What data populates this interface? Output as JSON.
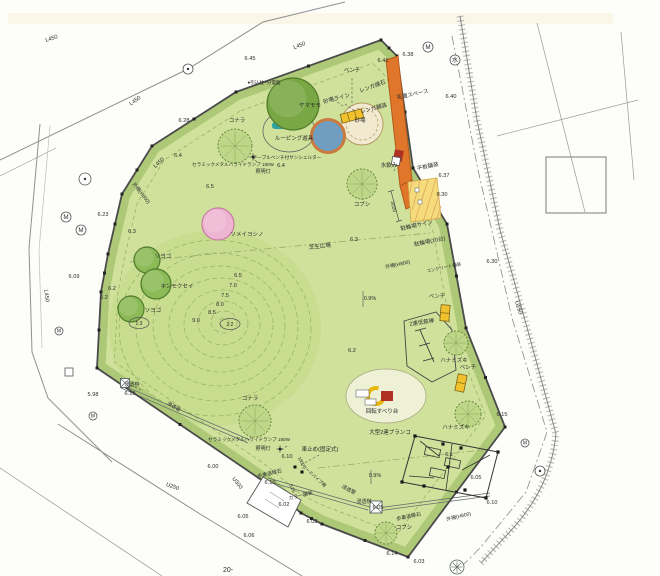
{
  "drawing": {
    "type": "park-landscape-site-plan",
    "page_number": "20-",
    "colors": {
      "park": "#cfe19b",
      "shrub": "#adc977",
      "mound": "#c9dd90",
      "contour": "#93b261",
      "orange": "#e0762a",
      "orange_dark": "#b35a1a",
      "parking": "#f6db7c",
      "parking_line": "#cfa84e",
      "sand": "#f2ead0",
      "sand_line": "#b59a62",
      "water_blue": "#6f9ec0",
      "shelter_ring": "#cb7a3e",
      "bench_yellow": "#f2c12e",
      "red": "#b03124",
      "teal": "#2fa3a0",
      "tree_dark": "#79a743",
      "tree_mid": "#8cba57",
      "tree_sketch": "#bdd687",
      "tree_pink": "#eeb5d2",
      "fence": "#4a4a4a",
      "road": "#8f8f8f",
      "ink": "#2b2b2b"
    },
    "labels": [
      {
        "t": "L450",
        "x": 52,
        "y": 40,
        "r": -18
      },
      {
        "t": "L450",
        "x": 136,
        "y": 102,
        "r": -35
      },
      {
        "t": "L450",
        "x": 300,
        "y": 47,
        "r": -21
      },
      {
        "t": "L450",
        "x": 160,
        "y": 164,
        "r": -42
      },
      {
        "t": "L450",
        "x": 45,
        "y": 296,
        "r": 83
      },
      {
        "t": "U250",
        "x": 517,
        "y": 308,
        "r": 72
      },
      {
        "t": "U300",
        "x": 236,
        "y": 484,
        "r": 52
      },
      {
        "t": "U250",
        "x": 172,
        "y": 488,
        "r": 20
      },
      {
        "t": "6.45",
        "x": 250,
        "y": 60
      },
      {
        "t": "6.41",
        "x": 383,
        "y": 62
      },
      {
        "t": "6.38",
        "x": 408,
        "y": 56
      },
      {
        "t": "6.40",
        "x": 451,
        "y": 98
      },
      {
        "t": "6.28",
        "x": 184,
        "y": 122
      },
      {
        "t": "6.4",
        "x": 178,
        "y": 157
      },
      {
        "t": "6.4",
        "x": 281,
        "y": 167
      },
      {
        "t": "6.5",
        "x": 210,
        "y": 188
      },
      {
        "t": "6.23",
        "x": 103,
        "y": 216
      },
      {
        "t": "6.3",
        "x": 132,
        "y": 233
      },
      {
        "t": "6.09",
        "x": 74,
        "y": 278
      },
      {
        "t": "6.2",
        "x": 112,
        "y": 290
      },
      {
        "t": "6.2",
        "x": 104,
        "y": 299
      },
      {
        "t": "6.5",
        "x": 238,
        "y": 277
      },
      {
        "t": "7.0",
        "x": 233,
        "y": 287
      },
      {
        "t": "7.5",
        "x": 225,
        "y": 297
      },
      {
        "t": "8.0",
        "x": 220,
        "y": 306
      },
      {
        "t": "8.5",
        "x": 212,
        "y": 314
      },
      {
        "t": "9.0",
        "x": 196,
        "y": 322
      },
      {
        "t": "5.98",
        "x": 93,
        "y": 396
      },
      {
        "t": "6.00",
        "x": 213,
        "y": 468
      },
      {
        "t": "6.10",
        "x": 130,
        "y": 395
      },
      {
        "t": "浸透桝",
        "x": 132,
        "y": 386,
        "s": 5
      },
      {
        "t": "浸透管",
        "x": 173,
        "y": 408,
        "r": 30,
        "s": 5
      },
      {
        "t": "ベンチ",
        "x": 352,
        "y": 72,
        "s": 5.5
      },
      {
        "t": "●引込柱~分電盤",
        "x": 264,
        "y": 84,
        "s": 4.6
      },
      {
        "t": "コナラ",
        "x": 237,
        "y": 122,
        "s": 5.5
      },
      {
        "t": "ヤマモモ",
        "x": 310,
        "y": 107,
        "s": 5.5
      },
      {
        "t": "レンガ縁石",
        "x": 373,
        "y": 88,
        "r": -20,
        "s": 5.5
      },
      {
        "t": "花壇スペース",
        "x": 413,
        "y": 96,
        "r": -12,
        "s": 5.5
      },
      {
        "t": "砂場ライン",
        "x": 337,
        "y": 100,
        "r": -15,
        "s": 5.5
      },
      {
        "t": "レンガ舗装",
        "x": 374,
        "y": 110,
        "r": -15,
        "s": 5.5
      },
      {
        "t": "砂場",
        "x": 360,
        "y": 122,
        "s": 5.5
      },
      {
        "t": "ルーピング遊具",
        "x": 294,
        "y": 140,
        "s": 5.5
      },
      {
        "t": "テーブルベンチ付サンシェルター",
        "x": 287,
        "y": 159,
        "s": 4.6
      },
      {
        "t": "セラミックメタルハライドランプ 180W",
        "x": 233,
        "y": 166,
        "s": 4.6
      },
      {
        "t": "照明灯",
        "x": 263,
        "y": 173,
        "s": 5
      },
      {
        "t": "水飲み",
        "x": 389,
        "y": 167,
        "s": 5.5
      },
      {
        "t": "平板舗装",
        "x": 428,
        "y": 168,
        "r": -12,
        "s": 5.5
      },
      {
        "t": "6.37",
        "x": 444,
        "y": 177
      },
      {
        "t": "6.30",
        "x": 442,
        "y": 196
      },
      {
        "t": "コブシ",
        "x": 362,
        "y": 206,
        "s": 5.5
      },
      {
        "t": "3000",
        "x": 392,
        "y": 207,
        "r": 78,
        "s": 5
      },
      {
        "t": "駐輪場サイン",
        "x": 417,
        "y": 227,
        "r": -12,
        "s": 5.5
      },
      {
        "t": "駐輪場(10台)",
        "x": 430,
        "y": 243,
        "r": -12,
        "s": 5.5
      },
      {
        "t": "外柵(H800)",
        "x": 398,
        "y": 266,
        "r": -12,
        "s": 5
      },
      {
        "t": "コンクリート舗装",
        "x": 444,
        "y": 269,
        "r": -12,
        "s": 4.4
      },
      {
        "t": "6.30",
        "x": 492,
        "y": 263
      },
      {
        "t": "外柵(H800)",
        "x": 140,
        "y": 194,
        "r": 52,
        "s": 5
      },
      {
        "t": "ソメイヨシノ",
        "x": 247,
        "y": 236,
        "s": 5.5
      },
      {
        "t": "ソヨゴ",
        "x": 163,
        "y": 258,
        "s": 5.5
      },
      {
        "t": "キンモクセイ",
        "x": 177,
        "y": 288,
        "s": 5.5
      },
      {
        "t": "ソヨゴ",
        "x": 153,
        "y": 312,
        "s": 5.5
      },
      {
        "t": "芝生広場",
        "x": 320,
        "y": 248,
        "r": -6,
        "s": 5.5
      },
      {
        "t": "6.3",
        "x": 354,
        "y": 241
      },
      {
        "t": "0.9%",
        "x": 370,
        "y": 300,
        "s": 5.5
      },
      {
        "t": "ベンチ",
        "x": 437,
        "y": 298,
        "s": 5.5
      },
      {
        "t": "2連低鉄棒",
        "x": 422,
        "y": 324,
        "r": -8,
        "s": 5.5
      },
      {
        "t": "ハナミズキ",
        "x": 454,
        "y": 362,
        "s": 5.5
      },
      {
        "t": "ベンチ",
        "x": 468,
        "y": 369,
        "s": 5.5
      },
      {
        "t": "6.2",
        "x": 352,
        "y": 352
      },
      {
        "t": "6.15",
        "x": 502,
        "y": 416
      },
      {
        "t": "回転すべり台",
        "x": 382,
        "y": 413,
        "s": 5.5
      },
      {
        "t": "大型2連ブランコ",
        "x": 390,
        "y": 434,
        "s": 5.5
      },
      {
        "t": "ハナミズキ",
        "x": 456,
        "y": 429,
        "s": 5.5
      },
      {
        "t": "6.1",
        "x": 449,
        "y": 456
      },
      {
        "t": "0.9%",
        "x": 375,
        "y": 477,
        "s": 5.5
      },
      {
        "t": "6.05",
        "x": 476,
        "y": 479
      },
      {
        "t": "6.10",
        "x": 492,
        "y": 504
      },
      {
        "t": "外柵(H800)",
        "x": 459,
        "y": 518,
        "r": -14,
        "s": 5
      },
      {
        "t": "歩車道縁石",
        "x": 409,
        "y": 518,
        "r": -12,
        "s": 5
      },
      {
        "t": "コブシ",
        "x": 404,
        "y": 529,
        "s": 5.5
      },
      {
        "t": "6.14",
        "x": 392,
        "y": 555
      },
      {
        "t": "6.03",
        "x": 419,
        "y": 563
      },
      {
        "t": "浸透桝",
        "x": 364,
        "y": 503,
        "s": 5
      },
      {
        "t": "6.05",
        "x": 378,
        "y": 509
      },
      {
        "t": "浸透管",
        "x": 348,
        "y": 491,
        "r": 28,
        "s": 5
      },
      {
        "t": "車止め(固定式)",
        "x": 320,
        "y": 451,
        "s": 5.5
      },
      {
        "t": "6.10",
        "x": 287,
        "y": 458
      },
      {
        "t": "1800",
        "x": 300,
        "y": 462,
        "r": 65,
        "s": 4.4
      },
      {
        "t": "歩車道縁石",
        "x": 270,
        "y": 475,
        "r": -14,
        "s": 5
      },
      {
        "t": "6.10",
        "x": 270,
        "y": 484
      },
      {
        "t": "3.25",
        "x": 291,
        "y": 489,
        "r": 65,
        "s": 4.6
      },
      {
        "t": "カラー舗装",
        "x": 301,
        "y": 497,
        "r": -14,
        "s": 5
      },
      {
        "t": "ガードパイプ柵",
        "x": 313,
        "y": 477,
        "r": 42,
        "s": 4.4
      },
      {
        "t": "6.02",
        "x": 284,
        "y": 506
      },
      {
        "t": "6.03",
        "x": 312,
        "y": 523
      },
      {
        "t": "6.05",
        "x": 243,
        "y": 518
      },
      {
        "t": "6.06",
        "x": 249,
        "y": 537
      },
      {
        "t": "セラミックメタルハライドランプ 180W",
        "x": 249,
        "y": 441,
        "s": 4.6
      },
      {
        "t": "照明灯",
        "x": 263,
        "y": 450,
        "s": 5
      },
      {
        "t": "コナラ",
        "x": 250,
        "y": 400,
        "s": 5.5
      },
      {
        "t": "20-",
        "x": 228,
        "y": 572,
        "s": 7
      }
    ],
    "ratio_tags": [
      {
        "t": "1:3",
        "x": 139,
        "y": 323
      },
      {
        "t": "1:2",
        "x": 230,
        "y": 324
      }
    ],
    "trees": [
      {
        "x": 293,
        "y": 104,
        "rad": 26,
        "kind": "round",
        "fill": "tree_dark",
        "name": "yamamomo"
      },
      {
        "x": 235,
        "y": 146,
        "rad": 17,
        "kind": "sketch",
        "fill": "tree_sketch",
        "name": "konara"
      },
      {
        "x": 218,
        "y": 224,
        "rad": 16,
        "kind": "pink",
        "fill": "tree_pink",
        "name": "someiyoshino"
      },
      {
        "x": 147,
        "y": 260,
        "rad": 13,
        "kind": "round",
        "fill": "tree_mid",
        "name": "soyogo"
      },
      {
        "x": 156,
        "y": 284,
        "rad": 15,
        "kind": "round",
        "fill": "tree_mid",
        "name": "kinmokusei"
      },
      {
        "x": 131,
        "y": 309,
        "rad": 13,
        "kind": "round",
        "fill": "tree_mid",
        "name": "soyogo"
      },
      {
        "x": 362,
        "y": 184,
        "rad": 15,
        "kind": "sketch",
        "fill": "tree_sketch",
        "name": "kobushi"
      },
      {
        "x": 456,
        "y": 343,
        "rad": 12,
        "kind": "sketch",
        "fill": "tree_sketch",
        "name": "hanamizuki"
      },
      {
        "x": 468,
        "y": 414,
        "rad": 13,
        "kind": "sketch",
        "fill": "tree_sketch",
        "name": "hanamizuki"
      },
      {
        "x": 255,
        "y": 421,
        "rad": 16,
        "kind": "sketch",
        "fill": "tree_sketch",
        "name": "konara"
      },
      {
        "x": 386,
        "y": 533,
        "rad": 11,
        "kind": "sketch",
        "fill": "tree_sketch",
        "name": "kobushi"
      }
    ],
    "benches": [
      {
        "x": 352,
        "y": 116,
        "w": 22,
        "h": 9,
        "r": -15,
        "cells": 3
      },
      {
        "x": 445,
        "y": 313,
        "w": 9,
        "h": 16,
        "r": 5,
        "cells": 2
      },
      {
        "x": 461,
        "y": 383,
        "w": 9,
        "h": 17,
        "r": 12,
        "cells": 2
      }
    ],
    "markers": [
      {
        "type": "circleM",
        "x": 428,
        "y": 47,
        "rad": 5
      },
      {
        "type": "circleWater",
        "x": 455,
        "y": 60,
        "rad": 5
      },
      {
        "type": "circleDot",
        "x": 188,
        "y": 69,
        "rad": 5
      },
      {
        "type": "circleDot",
        "x": 85,
        "y": 179,
        "rad": 6
      },
      {
        "type": "circleM",
        "x": 66,
        "y": 217,
        "rad": 5
      },
      {
        "type": "circleM",
        "x": 81,
        "y": 230,
        "rad": 5
      },
      {
        "type": "circleM",
        "x": 59,
        "y": 331,
        "rad": 4
      },
      {
        "type": "square",
        "x": 69,
        "y": 372,
        "rad": 4
      },
      {
        "type": "circleM",
        "x": 93,
        "y": 416,
        "rad": 4
      },
      {
        "type": "circleM",
        "x": 525,
        "y": 443,
        "rad": 4
      },
      {
        "type": "circleDot",
        "x": 540,
        "y": 471,
        "rad": 5
      },
      {
        "type": "circleTree",
        "x": 457,
        "y": 567,
        "rad": 7
      },
      {
        "type": "lamp",
        "x": 253,
        "y": 157
      },
      {
        "type": "lamp",
        "x": 280,
        "y": 449
      },
      {
        "type": "xbox",
        "x": 376,
        "y": 507,
        "rad": 6
      },
      {
        "type": "xbox",
        "x": 125,
        "y": 383,
        "rad": 4.5
      },
      {
        "type": "dotsq",
        "x": 295,
        "y": 467
      },
      {
        "type": "dotsq",
        "x": 302,
        "y": 472
      }
    ],
    "symbol_legend": {
      "circleM": "M",
      "circleWater": "水"
    }
  }
}
